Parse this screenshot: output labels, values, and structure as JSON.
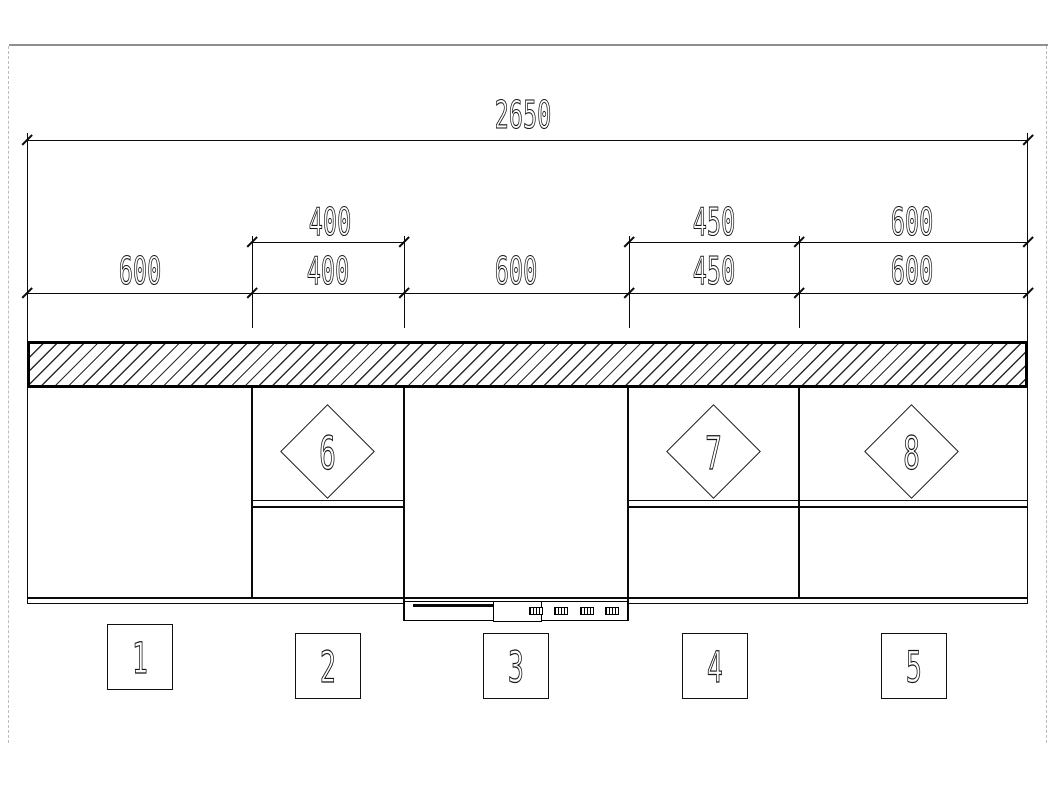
{
  "dims": {
    "overall": "2650",
    "tier2": [
      "400",
      "450",
      "600"
    ],
    "tier3": [
      "600",
      "400",
      "600",
      "450",
      "600"
    ]
  },
  "labels": {
    "squares": [
      "1",
      "2",
      "3",
      "4",
      "5"
    ],
    "diamonds": [
      "6",
      "7",
      "8"
    ]
  },
  "colors": {
    "line": "#0a0a0a",
    "hatch_line": "#2b2b2b",
    "paper_edge_top": "#8f8f8f",
    "paper_edge_dash": "#bdbdbd",
    "background": "#ffffff"
  }
}
